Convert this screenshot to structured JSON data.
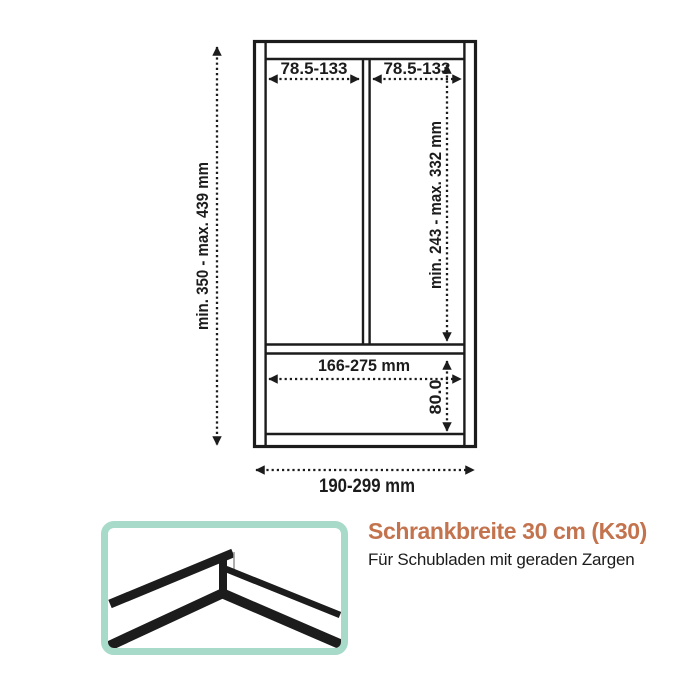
{
  "diagram": {
    "compartment_width_left": "78.5-133",
    "compartment_width_right": "78.5-133",
    "overall_depth": "min. 350 - max. 439 mm",
    "upper_compartment_depth": "min. 243 - max. 332 mm",
    "lower_compartment_width": "166-275 mm",
    "lower_compartment_depth": "80.0",
    "total_width": "190-299 mm"
  },
  "caption": {
    "title": "Schrankbreite 30 cm (K30)",
    "subtitle": "Für Schubladen mit geraden Zargen"
  },
  "colors": {
    "accent": "#C3734D",
    "photo_border": "#A7DAC8",
    "line": "#1C1C1C"
  },
  "photo": {
    "name": "divider-corner-illustration"
  }
}
